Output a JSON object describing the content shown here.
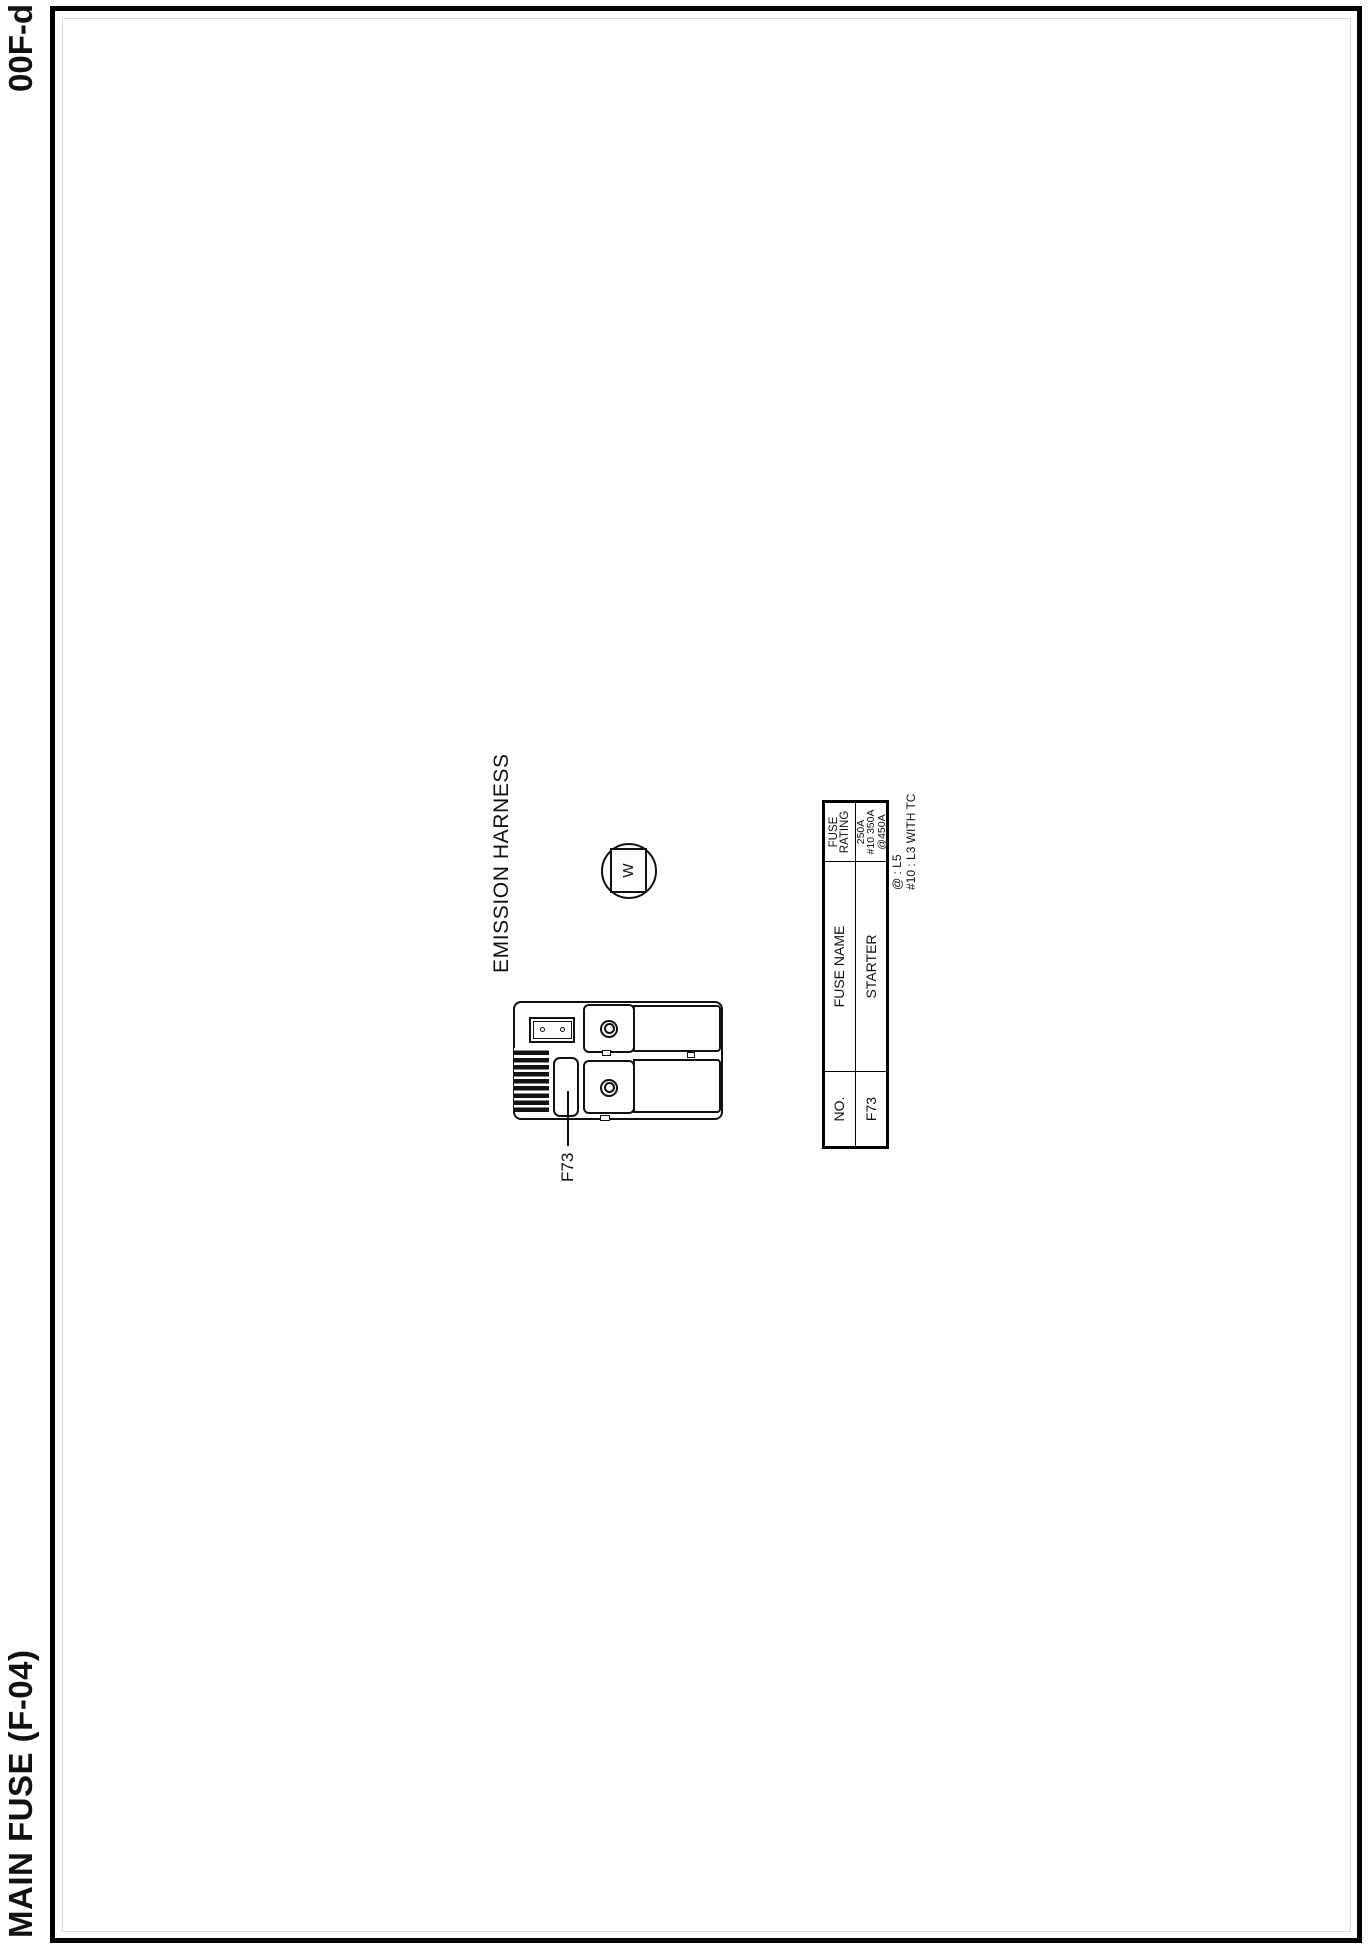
{
  "page": {
    "doc_title": "MAIN FUSE (F-04)",
    "page_code": "00F-d"
  },
  "diagram": {
    "harness_label": "EMISSION HARNESS",
    "wire_color_code": "W",
    "fuse_callout": "F73"
  },
  "fuse_table": {
    "header": {
      "no": "NO.",
      "name": "FUSE NAME",
      "rating_line1": "FUSE",
      "rating_line2": "RATING"
    },
    "rows": [
      {
        "no": "F73",
        "name": "STARTER",
        "rating_lines": [
          "250A",
          "#10 350A",
          "@450A"
        ]
      }
    ],
    "footnotes": [
      "@ : L5",
      "#10 : L3 WITH TC"
    ]
  },
  "colors": {
    "ink": "#111111",
    "paper": "#ffffff"
  }
}
